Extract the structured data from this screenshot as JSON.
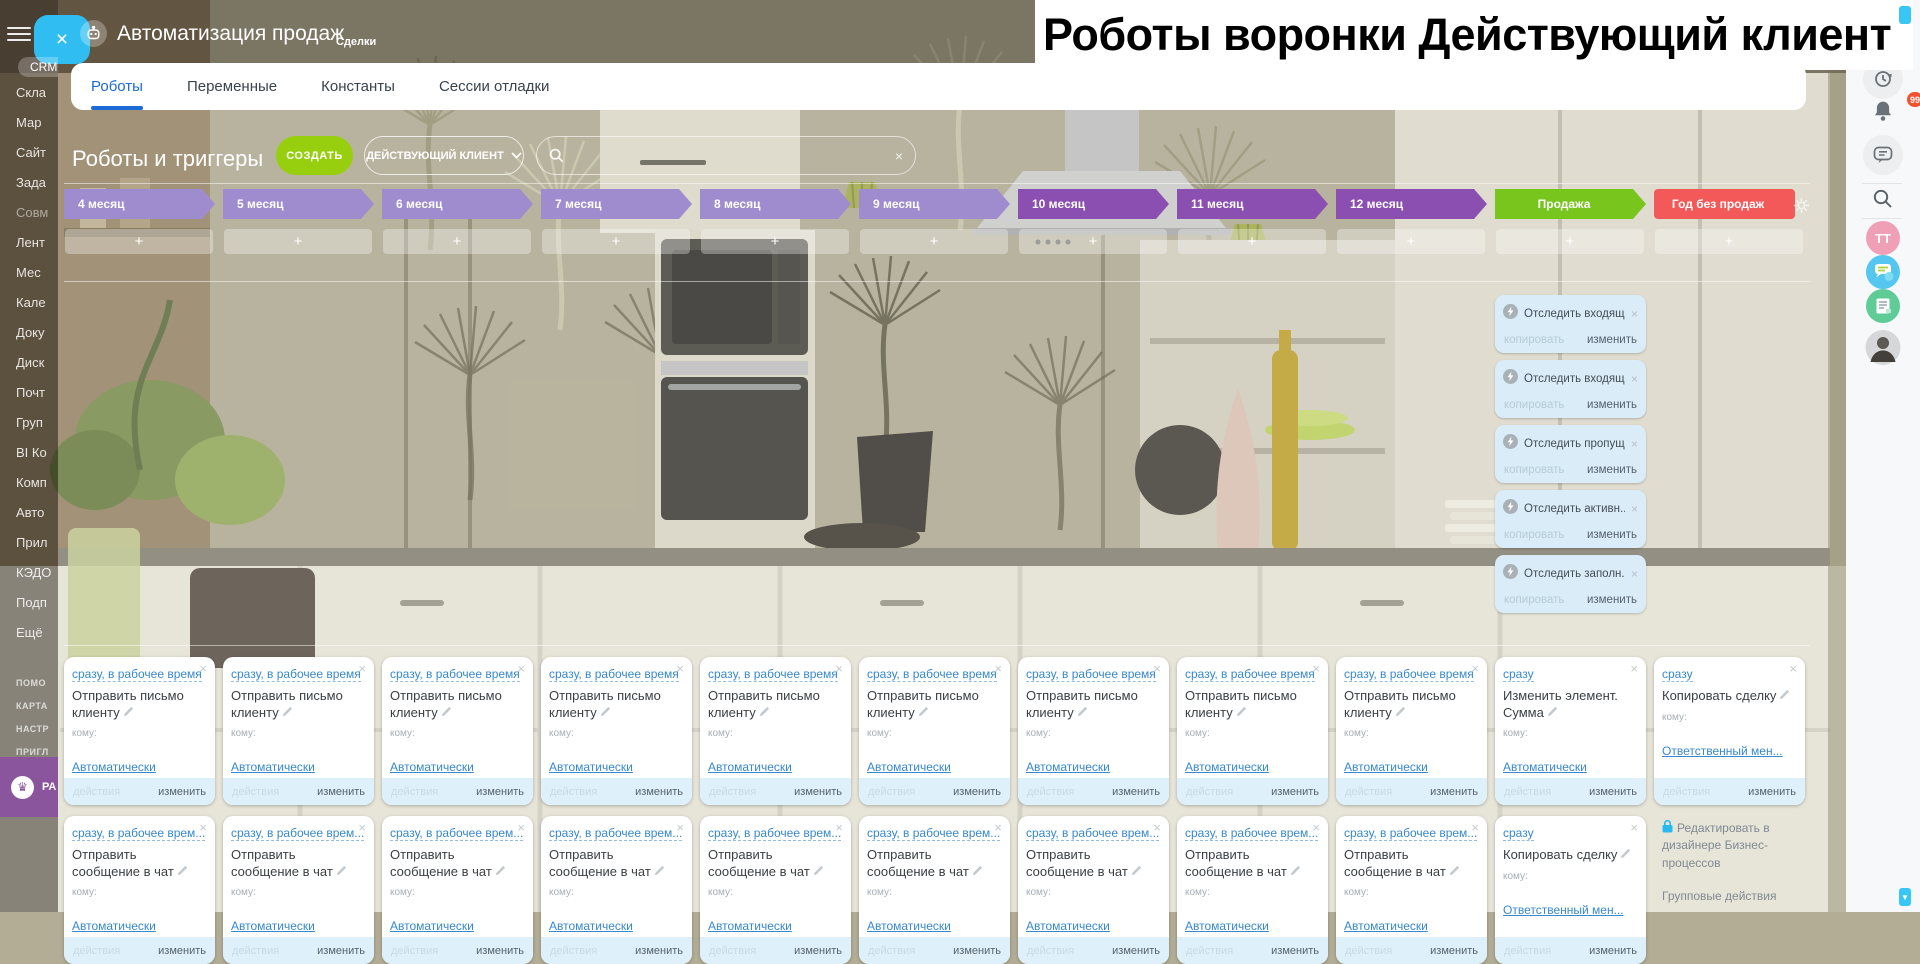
{
  "app": {
    "title": "Автоматизация продаж",
    "subtitle": "Сделки"
  },
  "overlay_title": "Роботы воронки Действующий клиент",
  "tabs": {
    "items": [
      "Роботы",
      "Переменные",
      "Константы",
      "Сессии отладки"
    ],
    "active_index": 0
  },
  "toolbar": {
    "heading": "Роботы и триггеры",
    "create_label": "СОЗДАТЬ",
    "funnel_label": "ДЕЙСТВУЮЩИЙ КЛИЕНТ",
    "search_placeholder": ""
  },
  "sidebar": {
    "items": [
      "CRM",
      "Скла",
      "Мар",
      "Сайт",
      "Зада",
      "Совм",
      "Лент",
      "Мес",
      "Кале",
      "Доку",
      "Диск",
      "Почт",
      "Груп",
      "BI Ко",
      "Комп",
      "Авто",
      "Прил",
      "КЭДО",
      "Подп",
      "Ещё"
    ],
    "footer_items": [
      "ПОМО",
      "КАРТА",
      "НАСТР",
      "ПРИГЛ"
    ],
    "banner_label": "РА",
    "banner_color": "#8a559c"
  },
  "board": {
    "stages": [
      {
        "label": "4 месяц",
        "color": "#9e8ccf",
        "shape": "arrow",
        "align": "left"
      },
      {
        "label": "5 месяц",
        "color": "#9e8ccf",
        "shape": "arrow",
        "align": "left"
      },
      {
        "label": "6 месяц",
        "color": "#9e8ccf",
        "shape": "arrow",
        "align": "left"
      },
      {
        "label": "7 месяц",
        "color": "#9e8ccf",
        "shape": "arrow",
        "align": "left"
      },
      {
        "label": "8 месяц",
        "color": "#9e8ccf",
        "shape": "arrow",
        "align": "left"
      },
      {
        "label": "9 месяц",
        "color": "#9e8ccf",
        "shape": "arrow",
        "align": "left"
      },
      {
        "label": "10 месяц",
        "color": "#8a4fb0",
        "shape": "arrow",
        "align": "left"
      },
      {
        "label": "11 месяц",
        "color": "#8a4fb0",
        "shape": "arrow",
        "align": "left"
      },
      {
        "label": "12 месяц",
        "color": "#8a4fb0",
        "shape": "arrow",
        "align": "left"
      },
      {
        "label": "Продажа",
        "color": "#77c51d",
        "shape": "arrow",
        "align": "center"
      },
      {
        "label": "Год без продаж",
        "color": "#f4595a",
        "shape": "rect",
        "align": "center"
      }
    ],
    "add_label": "+",
    "triggers": [
      {
        "title": "Отследить входящ..."
      },
      {
        "title": "Отследить входящ..."
      },
      {
        "title": "Отследить пропущ..."
      },
      {
        "title": "Отследить активн..."
      },
      {
        "title": "Отследить заполн..."
      }
    ],
    "trigger_labels": {
      "copy": "копировать",
      "edit": "изменить"
    },
    "card_labels": {
      "to": "кому:",
      "actions": "действия",
      "edit": "изменить"
    },
    "columns": [
      {
        "cards": [
          {
            "when": "сразу, в рабочее время",
            "action": "Отправить письмо клиенту",
            "to": "Автоматически"
          },
          {
            "when": "сразу, в рабочее врем...",
            "action": "Отправить сообщение в чат",
            "to": "Автоматически"
          }
        ]
      },
      {
        "cards": [
          {
            "when": "сразу, в рабочее время",
            "action": "Отправить письмо клиенту",
            "to": "Автоматически"
          },
          {
            "when": "сразу, в рабочее врем...",
            "action": "Отправить сообщение в чат",
            "to": "Автоматически"
          }
        ]
      },
      {
        "cards": [
          {
            "when": "сразу, в рабочее время",
            "action": "Отправить письмо клиенту",
            "to": "Автоматически"
          },
          {
            "when": "сразу, в рабочее врем...",
            "action": "Отправить сообщение в чат",
            "to": "Автоматически"
          }
        ]
      },
      {
        "cards": [
          {
            "when": "сразу, в рабочее время",
            "action": "Отправить письмо клиенту",
            "to": "Автоматически"
          },
          {
            "when": "сразу, в рабочее врем...",
            "action": "Отправить сообщение в чат",
            "to": "Автоматически"
          }
        ]
      },
      {
        "cards": [
          {
            "when": "сразу, в рабочее время",
            "action": "Отправить письмо клиенту",
            "to": "Автоматически"
          },
          {
            "when": "сразу, в рабочее врем...",
            "action": "Отправить сообщение в чат",
            "to": "Автоматически"
          }
        ]
      },
      {
        "cards": [
          {
            "when": "сразу, в рабочее время",
            "action": "Отправить письмо клиенту",
            "to": "Автоматически"
          },
          {
            "when": "сразу, в рабочее врем...",
            "action": "Отправить сообщение в чат",
            "to": "Автоматически"
          }
        ]
      },
      {
        "cards": [
          {
            "when": "сразу, в рабочее время",
            "action": "Отправить письмо клиенту",
            "to": "Автоматически"
          },
          {
            "when": "сразу, в рабочее врем...",
            "action": "Отправить сообщение в чат",
            "to": "Автоматически"
          }
        ]
      },
      {
        "cards": [
          {
            "when": "сразу, в рабочее время",
            "action": "Отправить письмо клиенту",
            "to": "Автоматически"
          },
          {
            "when": "сразу, в рабочее врем...",
            "action": "Отправить сообщение в чат",
            "to": "Автоматически"
          }
        ]
      },
      {
        "cards": [
          {
            "when": "сразу, в рабочее время",
            "action": "Отправить письмо клиенту",
            "to": "Автоматически"
          },
          {
            "when": "сразу, в рабочее врем...",
            "action": "Отправить сообщение в чат",
            "to": "Автоматически"
          }
        ]
      },
      {
        "cards": [
          {
            "when": "сразу",
            "action": "Изменить элемент. Сумма",
            "to": "Автоматически"
          },
          {
            "when": "сразу",
            "action": "Копировать сделку",
            "to": "Ответственный мен..."
          }
        ]
      },
      {
        "cards": [
          {
            "when": "сразу",
            "action": "Копировать сделку",
            "to": "Ответственный мен..."
          },
          null
        ]
      }
    ]
  },
  "bp": {
    "designer": "Редактировать в дизайнере Бизнес-процессов",
    "group": "Групповые действия"
  },
  "right_rail": {
    "badge": "99",
    "initials": "TT"
  },
  "colors": {
    "accent_blue": "#1b6ad6",
    "create_green": "#97cf0f",
    "sale_green": "#77c51d",
    "no_sale_red": "#f4595a",
    "stage_purple_light": "#9e8ccf",
    "stage_purple_dark": "#8a4fb0",
    "link_blue": "#3788cd",
    "scroll_blue": "#38c6f4"
  }
}
